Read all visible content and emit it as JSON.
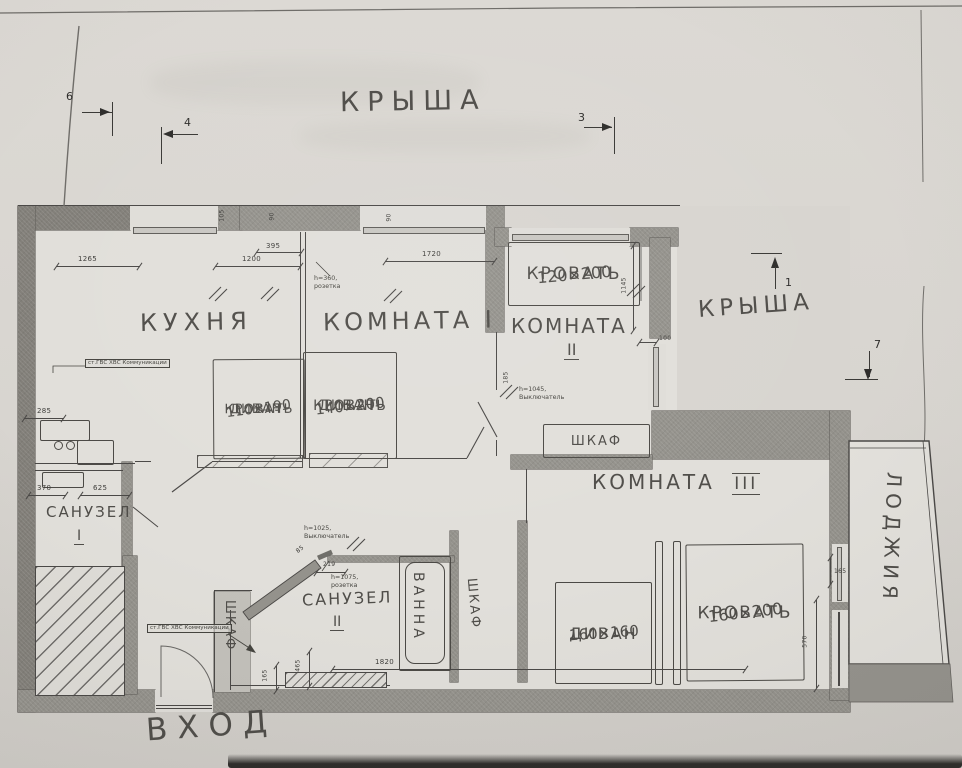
{
  "annotations": {
    "roof_top": "КРЫША",
    "roof_right": "КРЫША",
    "entrance": "ВХОД"
  },
  "markers": {
    "m1": "1",
    "m3": "3",
    "m4": "4",
    "m6": "6",
    "m7": "7"
  },
  "rooms": {
    "kitchen": "КУХНЯ",
    "room1": "КОМНАТА I",
    "room2": {
      "name": "КОМНАТА",
      "num": "II"
    },
    "room3": {
      "name": "КОМНАТА",
      "num": "III"
    },
    "bath1": {
      "name": "САНУЗЕЛ",
      "num": "I"
    },
    "bath2": {
      "name": "САНУЗЕЛ",
      "num": "II"
    },
    "loggia": "ЛОДЖИЯ",
    "bathtub": "ВАННА"
  },
  "furniture": {
    "sofabed1": {
      "line1": "ДИВАН-",
      "line2": "КРОВАТЬ",
      "size": "110×190"
    },
    "sofabed2": {
      "line1": "ДИВАН-",
      "line2": "КРОВАТЬ",
      "size": "140×200"
    },
    "bed_room2": {
      "name": "КРОВАТЬ",
      "size": "120×200"
    },
    "wardrobe_room2": "ШКАФ",
    "wardrobe_hall": "ШКАФ",
    "wardrobe_bath2": "ШКАФ",
    "sofa_room3": {
      "name": "ДИВАН",
      "size": "160×160"
    },
    "bed_room3": {
      "name": "КРОВАТЬ",
      "size": "160×200"
    }
  },
  "dimensions": {
    "w1265": "1265",
    "w1200": "1200",
    "w395": "395",
    "w1720": "1720",
    "w1820": "1820",
    "w100": "100",
    "w285": "285",
    "w370": "370",
    "w625": "625",
    "w219": "219",
    "v105": "105",
    "v90a": "90",
    "v90b": "90",
    "v185": "185",
    "v1145": "1145",
    "v570": "570",
    "v465": "465",
    "v165a": "165",
    "v165b": "165",
    "v85": "85"
  },
  "notes": {
    "socket360": {
      "line1": "h=360,",
      "line2": "розетка"
    },
    "switch1045": {
      "line1": "h=1045,",
      "line2": "Выключатель"
    },
    "switch1025": {
      "line1": "h=1025,",
      "line2": "Выключатель"
    },
    "socket1075": {
      "line1": "h=1075,",
      "line2": "розетка"
    },
    "pipes_top": "ст.ГВС ХВС Коммуникации",
    "pipes_bottom": "ст.ГВС ХВС Коммуникации"
  }
}
